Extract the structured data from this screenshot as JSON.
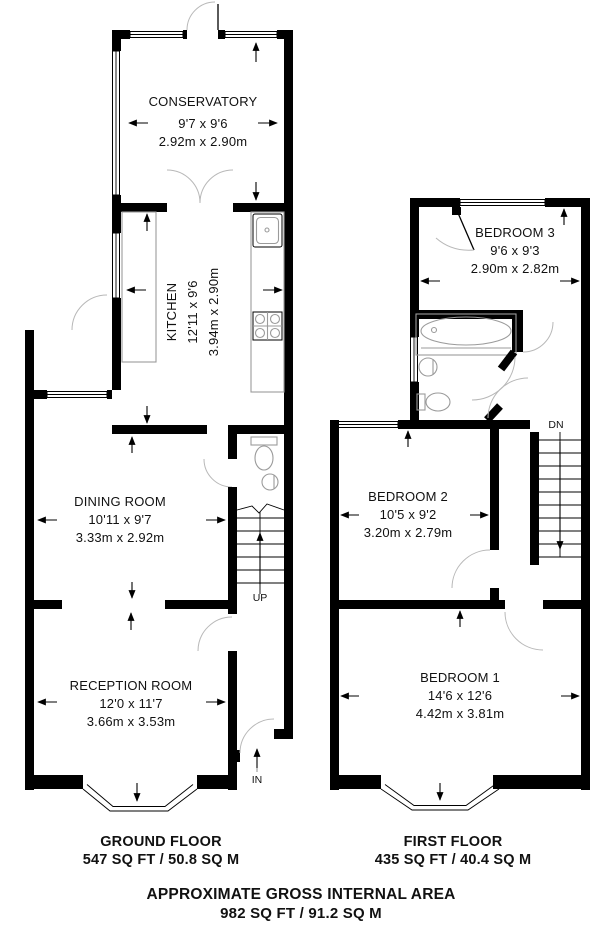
{
  "plan": {
    "ground": {
      "title": "GROUND FLOOR",
      "area": "547 SQ FT / 50.8 SQ M",
      "conservatory": {
        "name": "CONSERVATORY",
        "imperial": "9'7 x 9'6",
        "metric": "2.92m x 2.90m"
      },
      "kitchen": {
        "name": "KITCHEN",
        "imperial": "12'11 x 9'6",
        "metric": "3.94m x 2.90m"
      },
      "dining": {
        "name": "DINING ROOM",
        "imperial": "10'11 x 9'7",
        "metric": "3.33m x 2.92m"
      },
      "reception": {
        "name": "RECEPTION ROOM",
        "imperial": "12'0 x 11'7",
        "metric": "3.66m x 3.53m"
      },
      "up": "UP",
      "in": "IN"
    },
    "first": {
      "title": "FIRST FLOOR",
      "area": "435 SQ FT / 40.4 SQ M",
      "bedroom3": {
        "name": "BEDROOM 3",
        "imperial": "9'6 x 9'3",
        "metric": "2.90m x 2.82m"
      },
      "bedroom2": {
        "name": "BEDROOM 2",
        "imperial": "10'5 x 9'2",
        "metric": "3.20m x 2.79m"
      },
      "bedroom1": {
        "name": "BEDROOM 1",
        "imperial": "14'6 x 12'6",
        "metric": "4.42m x 3.81m"
      },
      "dn": "DN"
    },
    "footer": {
      "line1": "APPROXIMATE GROSS INTERNAL AREA",
      "line2": "982 SQ FT / 91.2 SQ M"
    }
  }
}
